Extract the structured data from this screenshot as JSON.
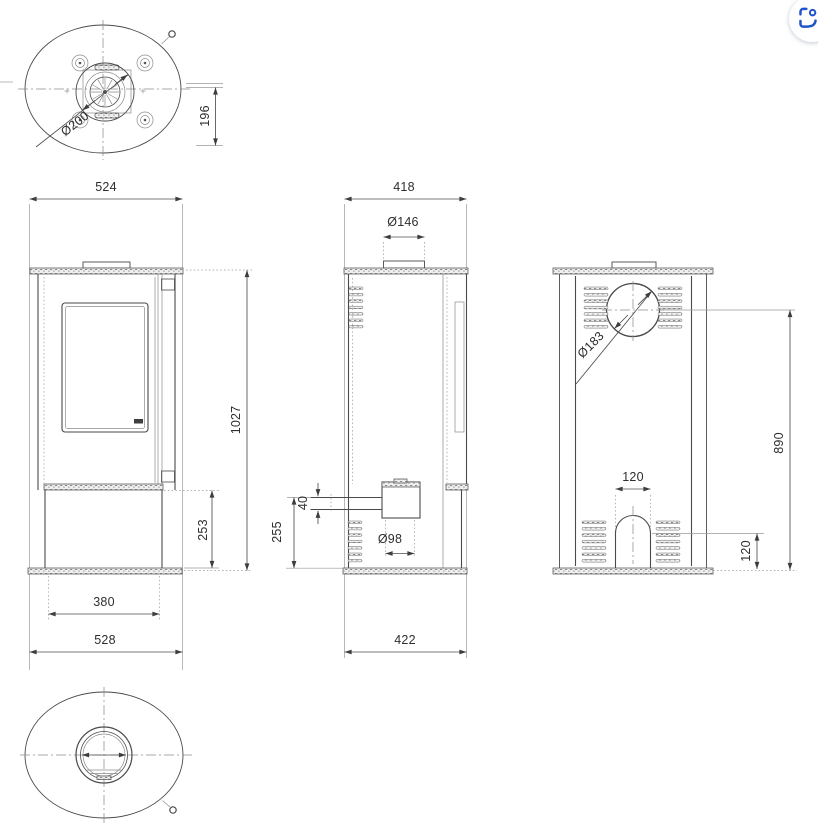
{
  "colors": {
    "background": "#ffffff",
    "line": "#4a4a4a",
    "dim_text": "#2e2e2e",
    "accent_blue": "#1e55cb"
  },
  "dims": {
    "top_view": {
      "collar_diameter": "Ø200",
      "collar_center_to_back": "196"
    },
    "front_view": {
      "top_width": "524",
      "height": "1027",
      "base_height": "253",
      "base_width": "380",
      "width": "528"
    },
    "side_view": {
      "top_depth": "418",
      "flue_collar_diameter": "Ø146",
      "air_inlet_drop": "40",
      "base_height": "255",
      "air_inlet_diameter": "Ø98",
      "depth": "422"
    },
    "back_view": {
      "flue_cutout_diameter": "Ø183",
      "flue_center_height": "890",
      "arch_width": "120",
      "arch_center_height": "120"
    }
  },
  "controls": {
    "visual_search": {
      "icon": "visual-search-icon"
    }
  }
}
